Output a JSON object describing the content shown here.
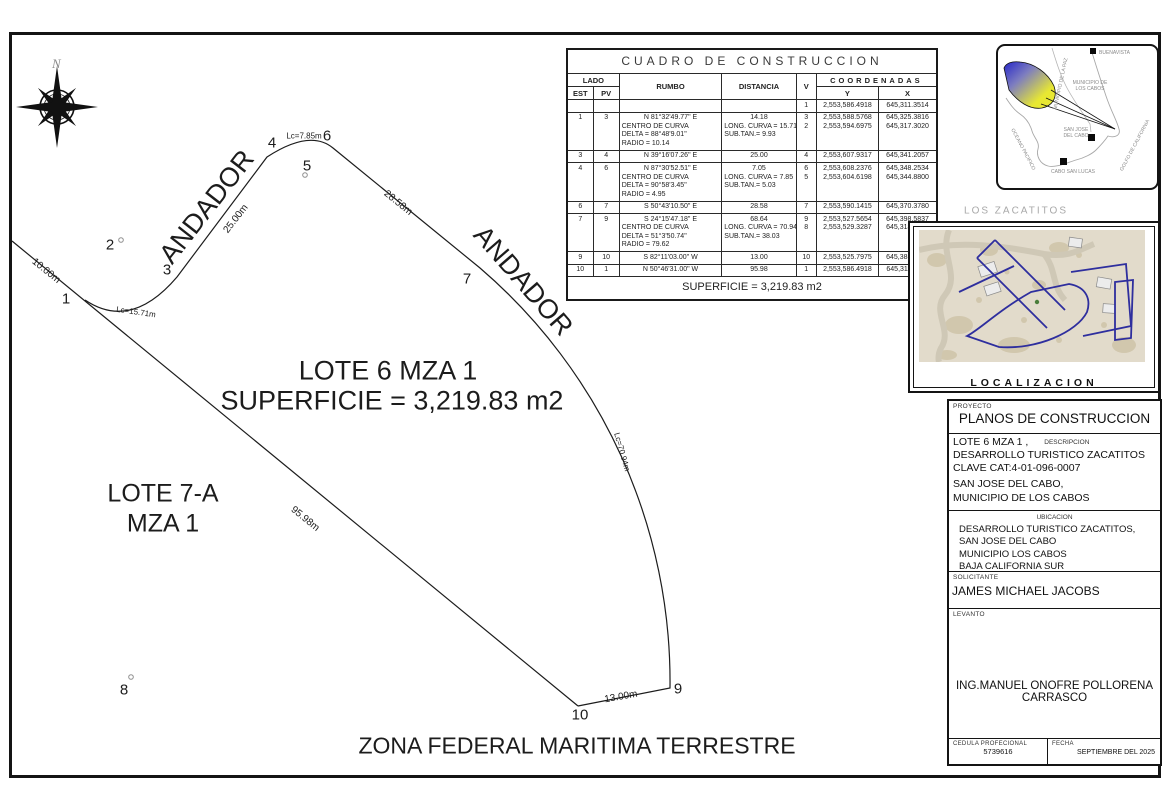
{
  "drawing": {
    "north_label": "N",
    "lot_title": "LOTE 6 MZA 1",
    "lot_area": "SUPERFICIE = 3,219.83 m2",
    "neighbor_lot": "LOTE 7-A",
    "neighbor_mza": "MZA 1",
    "andador_top": "ANDADOR",
    "andador_right": "ANDADOR",
    "zofemat": "ZONA FEDERAL MARITIMA TERRESTRE",
    "dims": {
      "d10": "10.00m",
      "lc1": "Lc=15.71m",
      "d25": "25.00m",
      "lc2": "Lc=7.85m",
      "d28": "28.58m",
      "lc3": "Lc=70.94m",
      "d95": "95.98m",
      "d13": "13.00m"
    },
    "vertices": [
      "1",
      "2",
      "3",
      "4",
      "5",
      "6",
      "7",
      "8",
      "9",
      "10"
    ]
  },
  "table": {
    "title": "CUADRO DE CONSTRUCCION",
    "headers": {
      "lado": "LADO",
      "est": "EST",
      "pv": "PV",
      "rumbo": "RUMBO",
      "distancia": "DISTANCIA",
      "v": "V",
      "coordenadas": "COORDENADAS",
      "y": "Y",
      "x": "X"
    },
    "rows": [
      {
        "est": "",
        "pv": "",
        "rumbo": [],
        "dist": [],
        "v": [
          "1"
        ],
        "y": [
          "2,553,586.4918"
        ],
        "x": [
          "645,311.3514"
        ]
      },
      {
        "est": "1",
        "pv": "3",
        "rumbo": [
          "N 81°32'49.77\" E",
          "CENTRO DE CURVA",
          "DELTA = 88°48'9.01\"",
          "RADIO = 10.14"
        ],
        "dist": [
          "14.18",
          "LONG. CURVA = 15.71",
          "SUB.TAN.= 9.93"
        ],
        "v": [
          "3",
          "2"
        ],
        "y": [
          "2,553,588.5768",
          "2,553,594.6975"
        ],
        "x": [
          "645,325.3816",
          "645,317.3020"
        ]
      },
      {
        "est": "3",
        "pv": "4",
        "rumbo": [
          "N 39°16'07.26\" E"
        ],
        "dist": [
          "25.00"
        ],
        "v": [
          "4"
        ],
        "y": [
          "2,553,607.9317"
        ],
        "x": [
          "645,341.2057"
        ]
      },
      {
        "est": "4",
        "pv": "6",
        "rumbo": [
          "N 87°30'52.51\" E",
          "CENTRO DE CURVA",
          "DELTA = 90°58'3.45\"",
          "RADIO = 4.95"
        ],
        "dist": [
          "7.05",
          "LONG. CURVA = 7.85",
          "SUB.TAN.= 5.03"
        ],
        "v": [
          "6",
          "5"
        ],
        "y": [
          "2,553,608.2376",
          "2,553,604.6198"
        ],
        "x": [
          "645,348.2534",
          "645,344.8800"
        ]
      },
      {
        "est": "6",
        "pv": "7",
        "rumbo": [
          "S 50°43'10.50\" E"
        ],
        "dist": [
          "28.58"
        ],
        "v": [
          "7"
        ],
        "y": [
          "2,553,590.1415"
        ],
        "x": [
          "645,370.3780"
        ]
      },
      {
        "est": "7",
        "pv": "9",
        "rumbo": [
          "S 24°15'47.18\" E",
          "CENTRO DE CURVA",
          "DELTA = 51°3'50.74\"",
          "RADIO = 79.62"
        ],
        "dist": [
          "68.64",
          "LONG. CURVA = 70.94",
          "SUB.TAN.= 38.03"
        ],
        "v": [
          "9",
          "8"
        ],
        "y": [
          "2,553,527.5654",
          "2,553,529.3287"
        ],
        "x": [
          "645,398.5837",
          "645,318.9783"
        ]
      },
      {
        "est": "9",
        "pv": "10",
        "rumbo": [
          "S 82°11'03.00\" W"
        ],
        "dist": [
          "13.00"
        ],
        "v": [
          "10"
        ],
        "y": [
          "2,553,525.7975"
        ],
        "x": [
          "645,385.7044"
        ]
      },
      {
        "est": "10",
        "pv": "1",
        "rumbo": [
          "N 50°46'31.00\" W"
        ],
        "dist": [
          "95.98"
        ],
        "v": [
          "1"
        ],
        "y": [
          "2,553,586.4918"
        ],
        "x": [
          "645,311.3514"
        ]
      }
    ],
    "footer": "SUPERFICIE = 3,219.83 m2"
  },
  "region_map": {
    "buenavista": "BUENAVISTA",
    "municipio": [
      "MUNICIPIO DE",
      "LOS CABOS"
    ],
    "san_jose": [
      "SAN JOSE",
      "DEL CABO"
    ],
    "cabo_san_lucas": "CABO SAN LUCAS",
    "oceano": "OCEANO PACIFICO",
    "golfo": "GOLFO DE CALIFORNIA",
    "la_paz": "MUNICIPIO DE LA PAZ"
  },
  "localization": {
    "title": "LOS ZACATITOS",
    "caption": "LOCALIZACION"
  },
  "info_panel": {
    "proyecto_label": "PROYECTO",
    "proyecto": "PLANOS DE CONSTRUCCION",
    "descripcion_label": "DESCRIPCION",
    "desc_line1": "LOTE 6 MZA 1 ,",
    "desc_line2": "DESARROLLO TURISTICO ZACATITOS",
    "desc_line3": "CLAVE CAT:4-01-096-0007",
    "desc_line4": "SAN JOSE DEL CABO,",
    "desc_line5": "MUNICIPIO DE LOS CABOS",
    "ubicacion_label": "UBICACION",
    "ubic_line1": "DESARROLLO TURISTICO ZACATITOS,",
    "ubic_line2": "SAN JOSE DEL CABO",
    "ubic_line3": "MUNICIPIO LOS CABOS",
    "ubic_line4": "BAJA CALIFORNIA SUR",
    "solicitante_label": "SOLICITANTE",
    "solicitante": "JAMES MICHAEL JACOBS",
    "levanto_label": "LEVANTO",
    "levanto": "ING.MANUEL ONOFRE POLLORENA CARRASCO",
    "cedula_label": "CEDULA PROFECIONAL",
    "cedula": "5739616",
    "fecha_label": "FECHA",
    "fecha": "SEPTIEMBRE DEL 2025"
  },
  "colors": {
    "line": "#1c1c1c",
    "lot_outline_blue": "#2e2e9e",
    "flag_blue": "#2727c8",
    "flag_yellow": "#e8e832",
    "sat_bg": "#e2dbcb"
  }
}
